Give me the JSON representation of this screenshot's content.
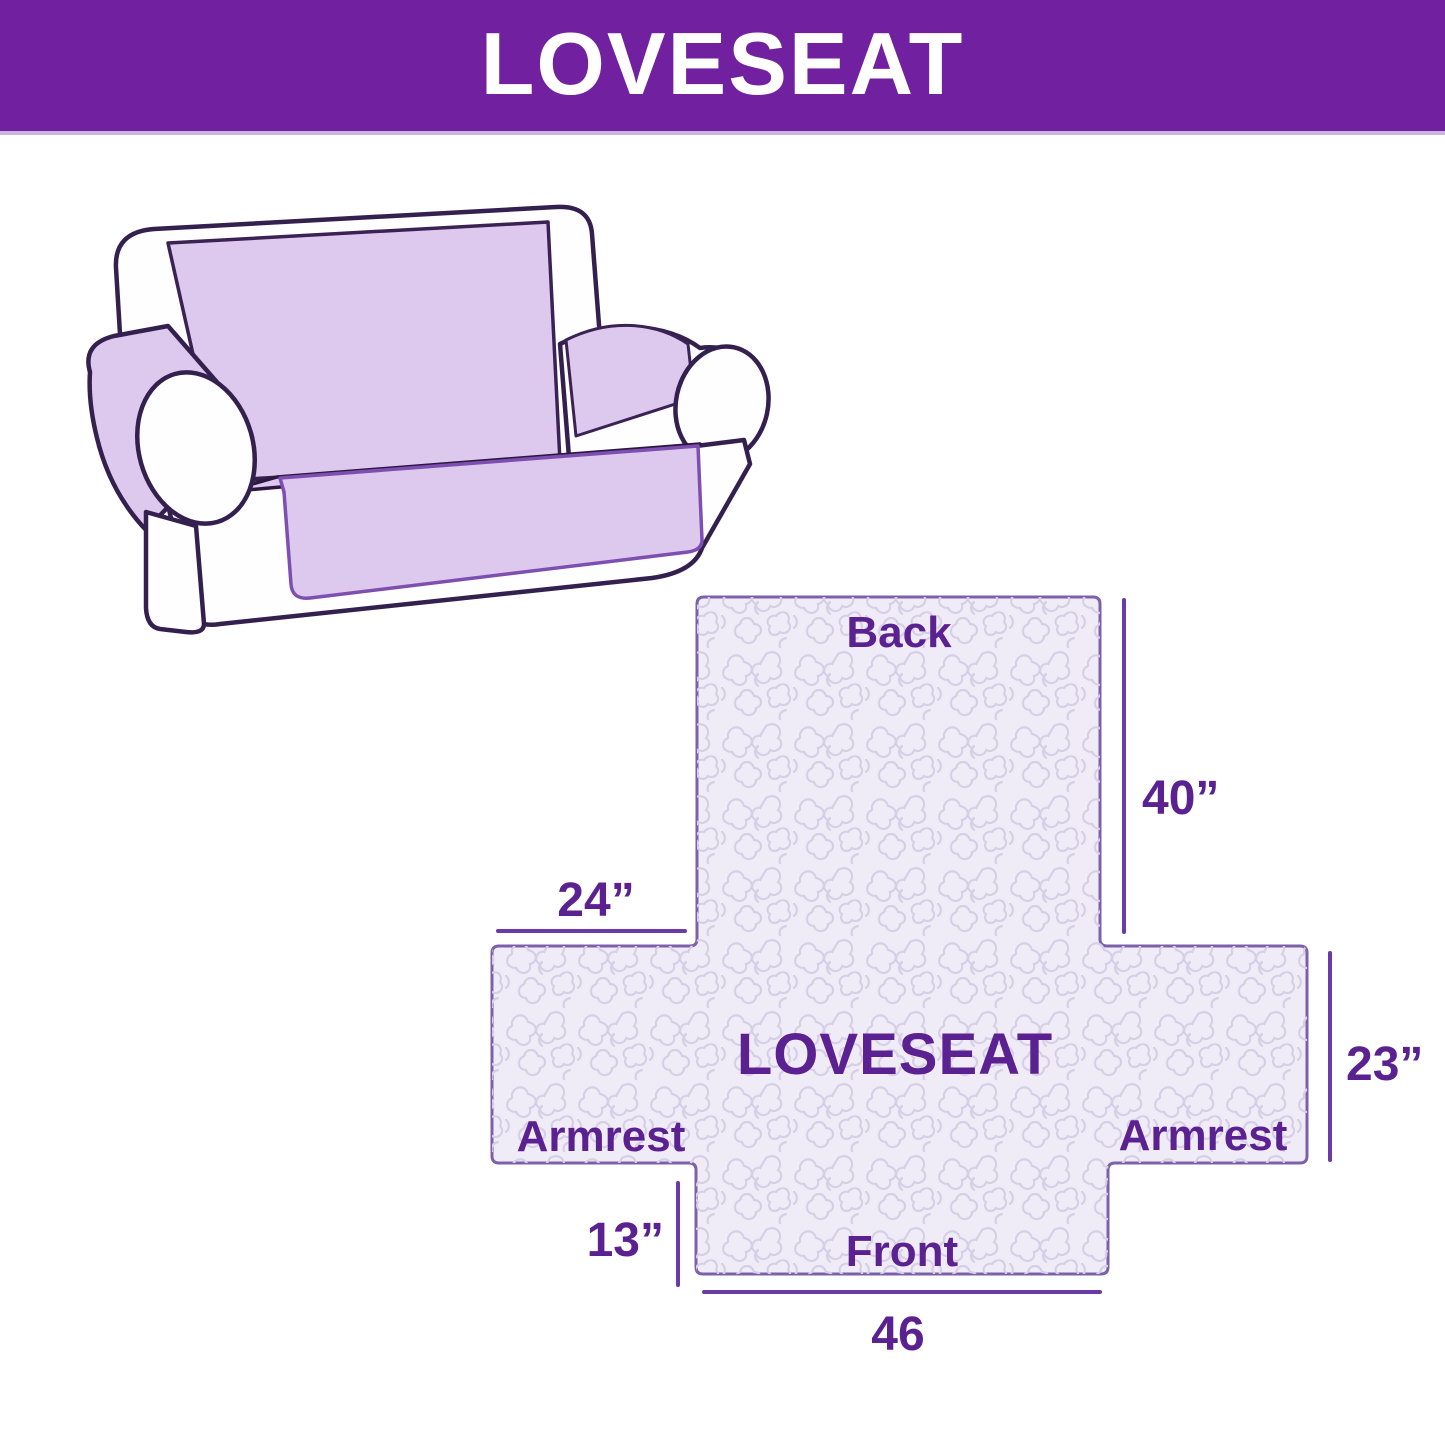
{
  "banner": {
    "title": "LOVESEAT",
    "background_color": "#7121A0",
    "text_color": "#FFFFFF"
  },
  "illustration": {
    "description": "loveseat sofa line drawing with lavender slipcover",
    "cover_color": "#DEC9EE",
    "outline_color": "#34204E"
  },
  "diagram": {
    "fill_color": "#F0ECF7",
    "border_color": "#7B61A9",
    "pattern_color": "#D7CFE6",
    "label_color": "#5B2191",
    "line_color": "#6B3AA8",
    "labels": {
      "back": "Back",
      "center": "LOVESEAT",
      "armrest_left": "Armrest",
      "armrest_right": "Armrest",
      "front": "Front"
    },
    "dimensions": {
      "back_height": "40”",
      "armrest_left_width": "24”",
      "armrest_height": "23”",
      "front_flap_height": "13”",
      "front_width": "46"
    }
  }
}
